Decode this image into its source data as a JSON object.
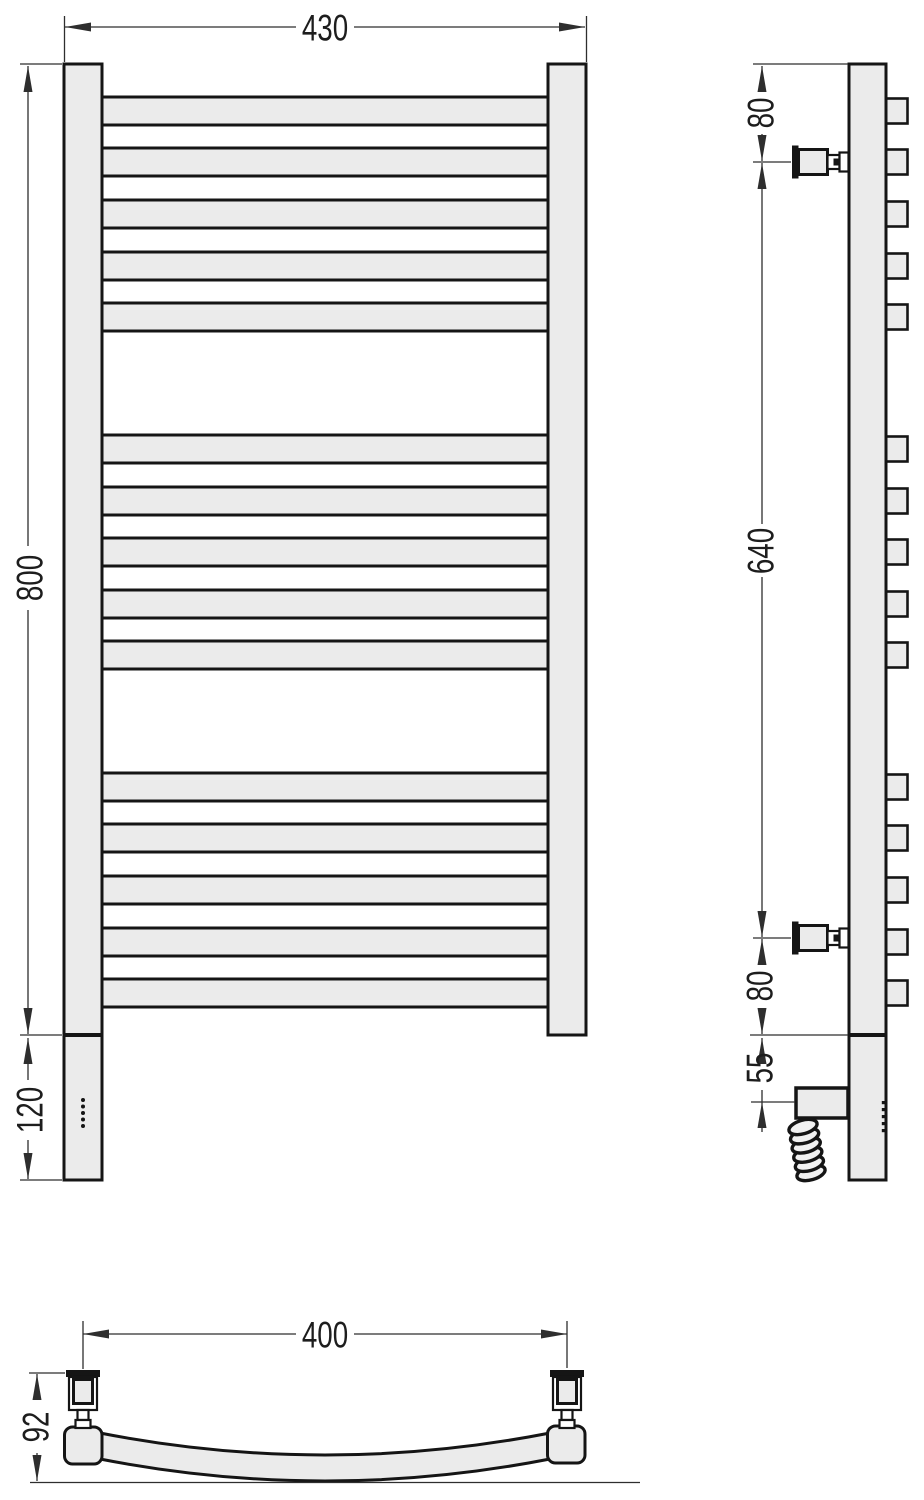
{
  "drawing": {
    "type": "towel-rail-technical-drawing"
  },
  "dimensions": {
    "front_width": "430",
    "front_height": "800",
    "front_lower": "120",
    "side_top_offset": "80",
    "side_bracket_span": "640",
    "side_bottom_offset": "80",
    "side_element_offset": "55",
    "bottom_bracket_span": "400",
    "bottom_depth": "92"
  },
  "colors": {
    "fill": "#ebebeb",
    "outline": "#151515",
    "dimension": "#2e2e2e"
  }
}
